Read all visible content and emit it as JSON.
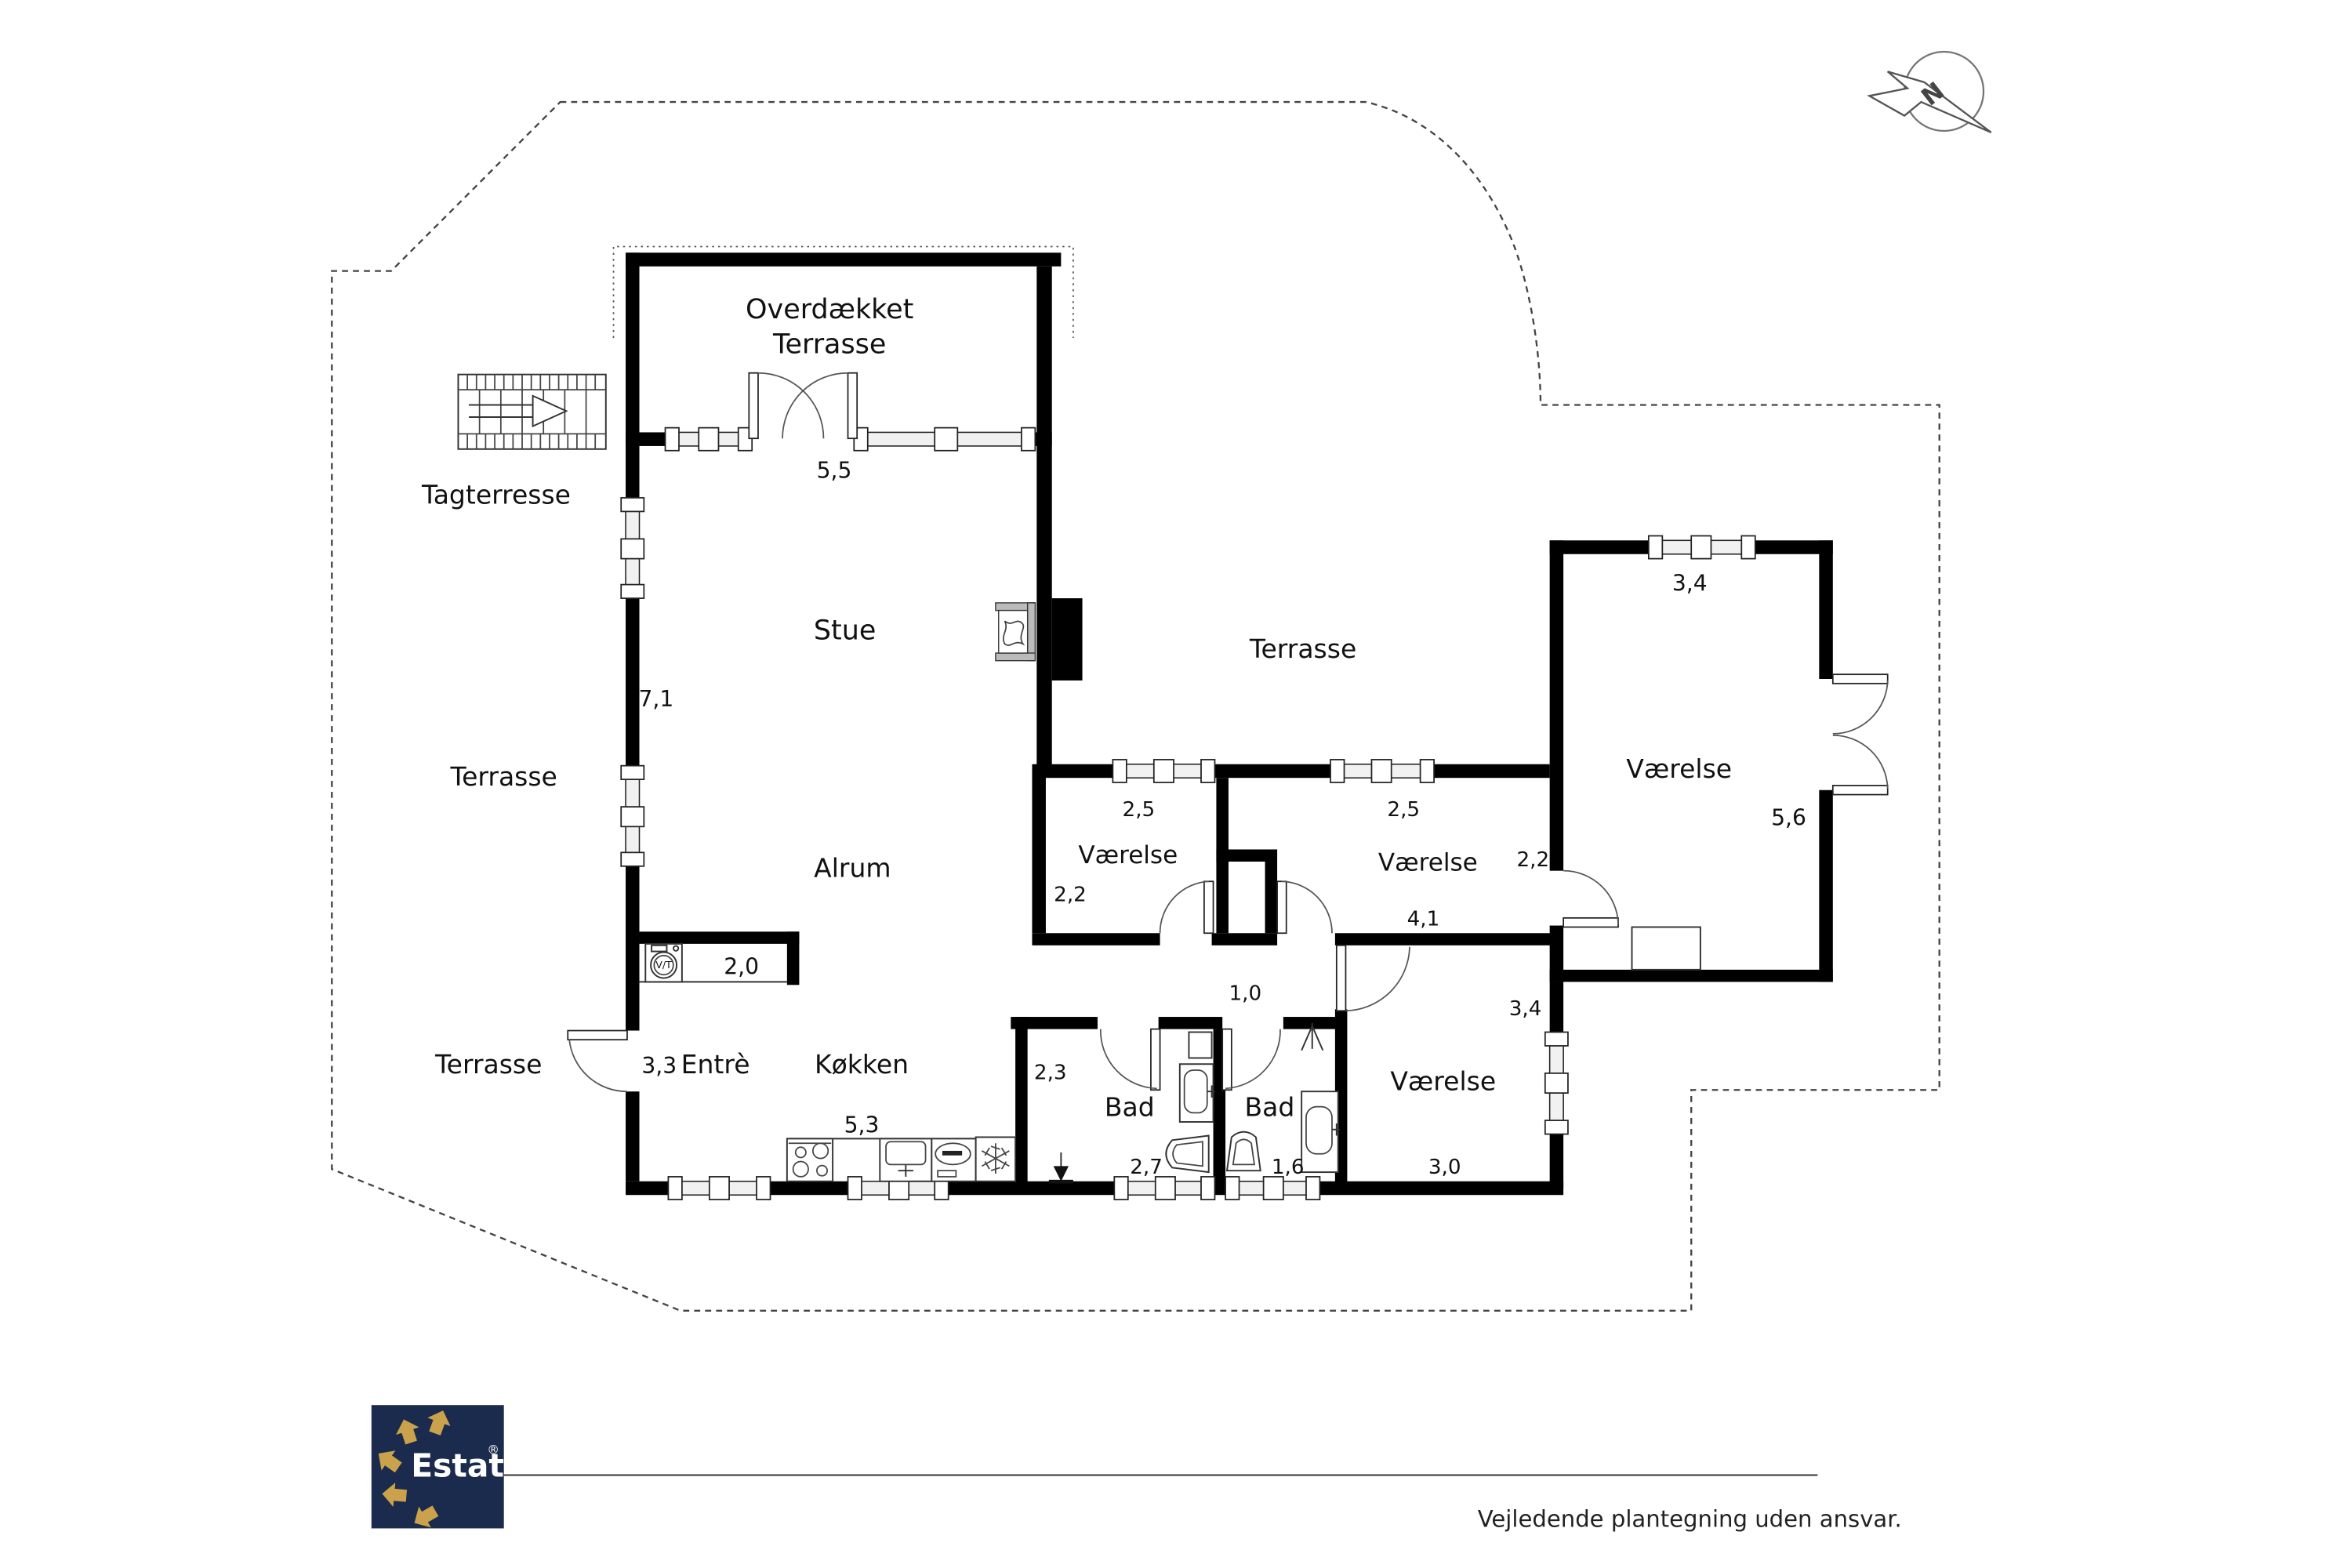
{
  "compass": {
    "north_letter": "N"
  },
  "plan": {
    "areas": {
      "covered_terrace": {
        "line1": "Overdækket",
        "line2": "Terrasse",
        "width": "5,5"
      },
      "roof_terrace": {
        "label": "Tagterresse"
      },
      "living_room": {
        "label": "Stue",
        "depth": "7,1"
      },
      "terrace_west": {
        "label": "Terrasse"
      },
      "terrace_east": {
        "label": "Terrasse"
      },
      "terrace_southwest": {
        "label": "Terrasse"
      },
      "family_room": {
        "label": "Alrum"
      },
      "utility": {
        "label": "V/T",
        "width": "2,0"
      },
      "entry": {
        "label": "Entrè",
        "width": "3,3"
      },
      "kitchen": {
        "label": "Køkken",
        "width": "5,3"
      },
      "bedroom_left": {
        "label": "Værelse",
        "width": "2,5",
        "depth": "2,2"
      },
      "bedroom_mid": {
        "label": "Værelse",
        "width": "2,5",
        "door": "2,2",
        "length": "4,1"
      },
      "hall": {
        "width": "1,0"
      },
      "bedroom_east": {
        "label": "Værelse",
        "width": "3,4",
        "depth": "5,6"
      },
      "bedroom_south": {
        "label": "Værelse",
        "width": "3,0",
        "depth": "3,4"
      },
      "bath_left": {
        "label": "Bad",
        "width": "2,3",
        "depth": "2,7"
      },
      "bath_right": {
        "label": "Bad",
        "width": "1,6"
      }
    }
  },
  "logo": {
    "brand": "Estate",
    "registered": "®"
  },
  "footer": {
    "disclaimer": "Vejledende plantegning uden ansvar."
  },
  "colors": {
    "wall": "#000000",
    "logo_bg": "#1b2b4d",
    "logo_gold": "#c9a24b",
    "boundary": "#444444"
  }
}
